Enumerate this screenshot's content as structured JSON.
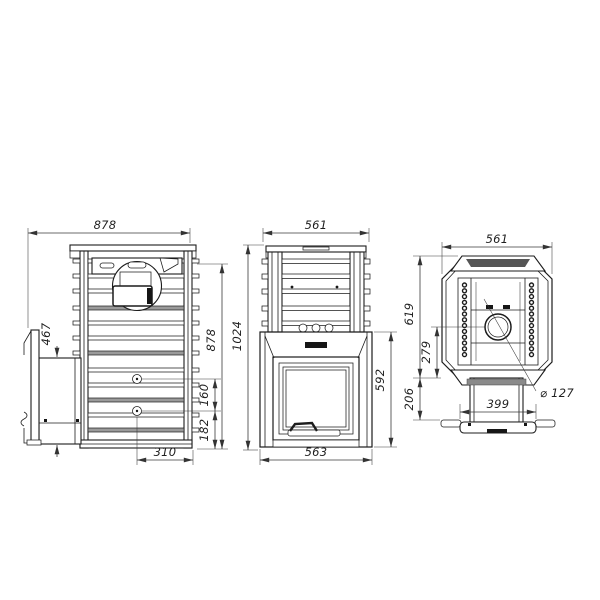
{
  "colors": {
    "background": "#ffffff",
    "line": "#1c1c1c",
    "dimension": "#3a3a3a",
    "shade": "#9a9a9a"
  },
  "views": {
    "side": {
      "dims": {
        "overall_depth": "878",
        "body_height": "878",
        "fuel_channel_height": "467",
        "mount_spacing": "160",
        "mount_to_base": "182",
        "mount_offset": "310"
      }
    },
    "front": {
      "dims": {
        "top_width": "561",
        "overall_height": "1024",
        "firebox_height": "592",
        "base_width": "563"
      }
    },
    "top": {
      "dims": {
        "width": "561",
        "depth": "619",
        "flue_to_front": "279",
        "tunnel_protrusion": "206",
        "flange_width": "399",
        "flue_diameter": "⌀ 127"
      }
    }
  }
}
